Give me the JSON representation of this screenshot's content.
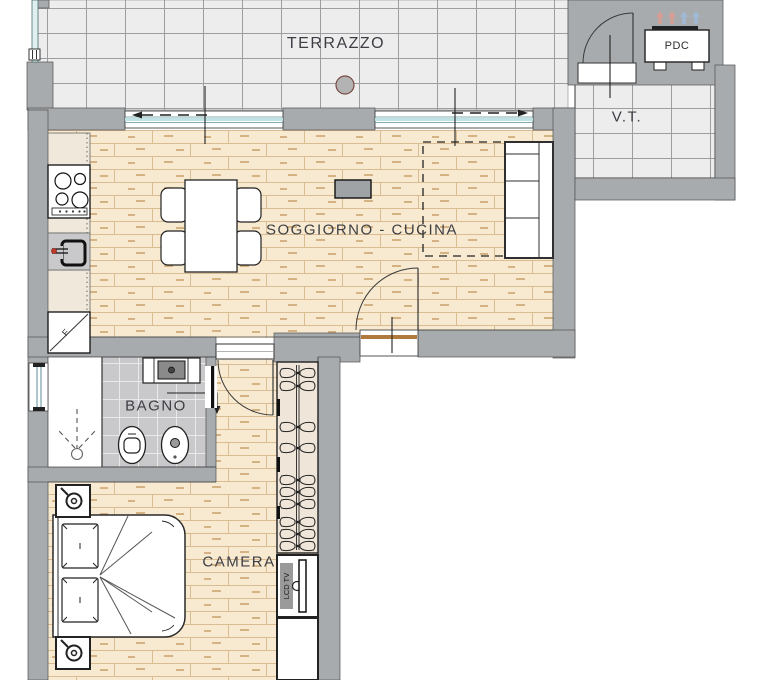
{
  "plan": {
    "rooms": [
      {
        "id": "terrazzo",
        "label": "TERRAZZO"
      },
      {
        "id": "vt",
        "label": "V.T."
      },
      {
        "id": "soggiorno_cucina",
        "label": "SOGGIORNO - CUCINA"
      },
      {
        "id": "bagno",
        "label": "BAGNO"
      },
      {
        "id": "camera",
        "label": "CAMERA"
      }
    ],
    "equipment": [
      {
        "id": "pdc",
        "label": "PDC"
      },
      {
        "id": "lcd_tv",
        "label": "LCD TV"
      },
      {
        "id": "fridge",
        "label": "F"
      }
    ]
  },
  "labels": {
    "terrazzo": "TERRAZZO",
    "vt": "V.T.",
    "soggiorno": "SOGGIORNO - CUCINA",
    "bagno": "BAGNO",
    "camera": "CAMERA",
    "pdc": "PDC",
    "lcd_tv": "LCD TV",
    "fridge": "F"
  },
  "colors": {
    "wall": "#a8abad",
    "parquet_base": "#f7ead0",
    "parquet_line": "#d9bc92",
    "terrace_tile": "#ededee",
    "terrace_grid": "#9c9ea0",
    "bath_tile": "#c9c9cb",
    "bath_grout": "#e9e9e9",
    "glass": "#cfe9ea",
    "counter": "#f0e9db",
    "wardrobe": "#efe5d8",
    "label_text": "#3d3d44",
    "arrow_warm": "#d79e96",
    "arrow_cool": "#9fb9d6",
    "threshold_wood": "#b07a3c",
    "drain_stroke": "#7a4a42",
    "faucet_dot": "#c0392b"
  }
}
